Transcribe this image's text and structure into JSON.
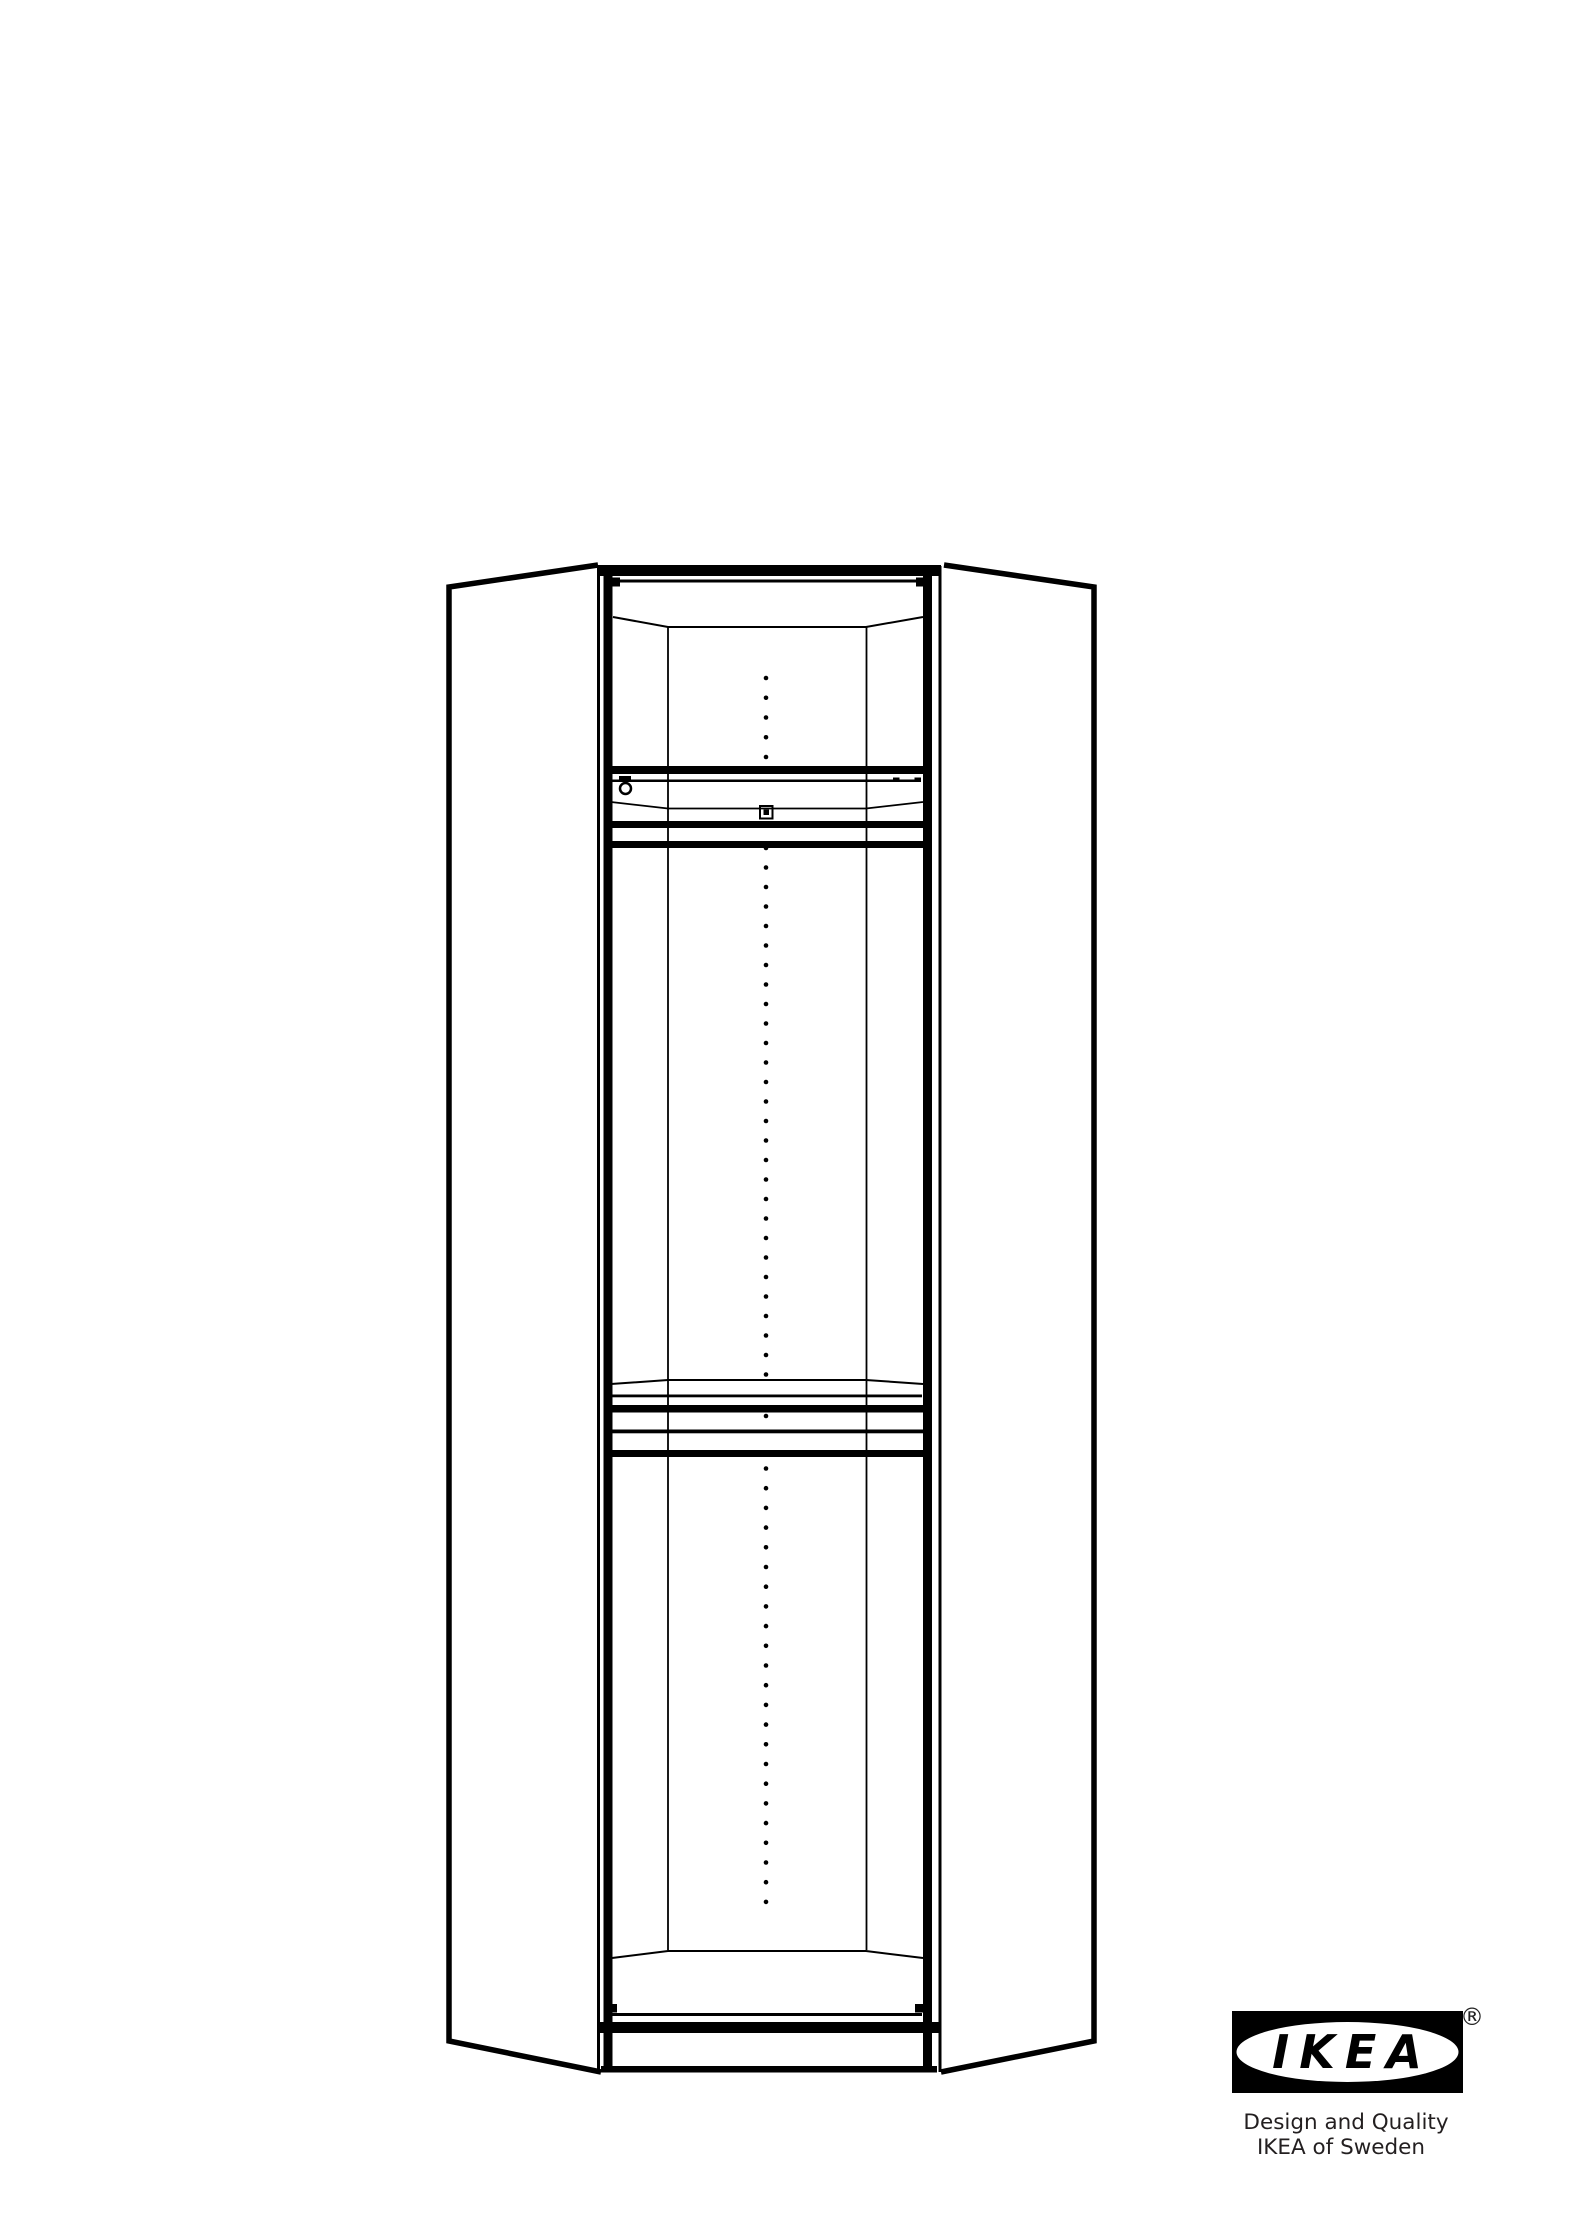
{
  "page": {
    "background_color": "#ffffff",
    "line_color": "#000000"
  },
  "illustration": {
    "name": "corner-wardrobe-frame-front-view",
    "shelf_pin_hole_columns": [
      {
        "name": "top-section-holes",
        "x": 766,
        "y_start": 678,
        "spacing": 19.75,
        "count": 5,
        "radius": 2.3
      },
      {
        "name": "middle-section-holes",
        "x": 766,
        "y_start": 848,
        "spacing": 19.5,
        "count": 28,
        "radius": 2.3
      },
      {
        "name": "bottom-section-holes",
        "x": 766,
        "y_start": 1468.5,
        "spacing": 19.7,
        "count": 23,
        "radius": 2.3
      }
    ]
  },
  "logo": {
    "brand": "IKEA",
    "registered_mark": "®",
    "tagline_line1": "Design and Quality",
    "tagline_line2": "IKEA of Sweden",
    "logo_color": "#000000",
    "tagline_color": "#231f20"
  }
}
